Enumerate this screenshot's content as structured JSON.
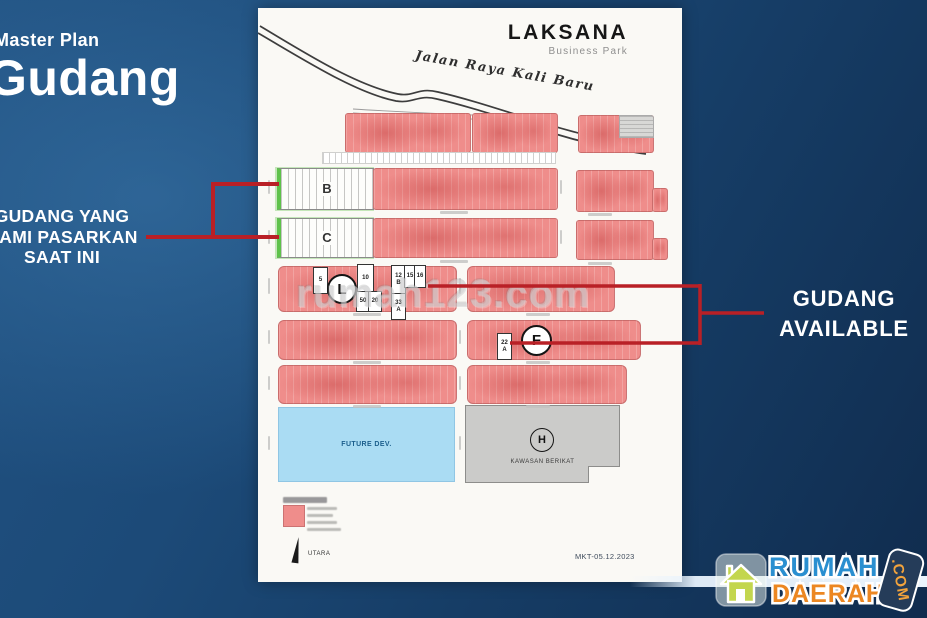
{
  "left_panel": {
    "kicker": "Master Plan",
    "title": "Gudang",
    "callout": [
      "GUDANG YANG",
      "KAMI PASARKAN",
      "SAAT INI"
    ]
  },
  "right_panel": {
    "callout": [
      "GUDANG",
      "AVAILABLE"
    ]
  },
  "watermark": "rumah123.com",
  "plan": {
    "brand": "LAKSANA",
    "tagline": "Business Park",
    "road_label": "Jalan Raya Kali Baru",
    "footer_code": "MKT-05.12.2023",
    "north_label": "UTARA",
    "blocks": {
      "b": "B",
      "c": "C",
      "l": "L",
      "f": "F",
      "h": "H",
      "future": "FUTURE DEV.",
      "bonded": "KAWASAN BERIKAT"
    },
    "units": {
      "u5": "5",
      "u10": "10",
      "u50": "50",
      "u20": "20",
      "u12": "12",
      "u12s": "B",
      "u15": "15",
      "u16": "16",
      "u33": "33",
      "u33s": "A",
      "u22": "22",
      "u22s": "A"
    },
    "colors": {
      "sold_fill": "#ef8d8b",
      "marketed_outline": "#5ec24a",
      "callout_line": "#b92026",
      "future_fill": "#aadcf3",
      "bonded_fill": "#cbcbc9"
    }
  },
  "logo": {
    "word1": "RUMAH",
    "word2": "DAERAH",
    "tld": ".COM"
  }
}
